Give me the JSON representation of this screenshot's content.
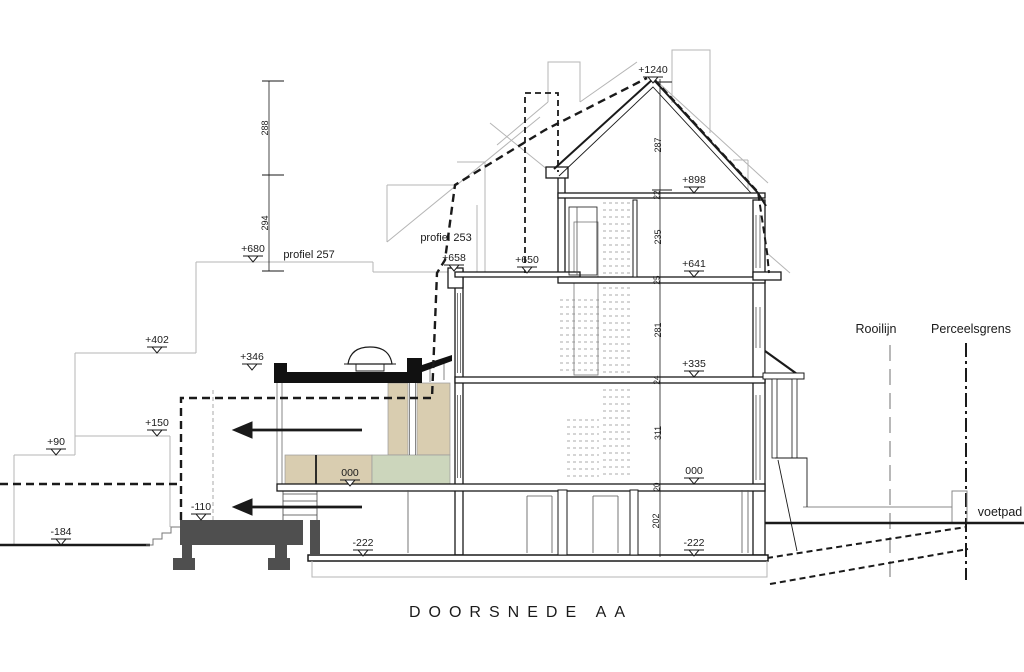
{
  "drawing": {
    "title": "DOORSNEDE AA",
    "annotations": {
      "profiel_257": "profiel 257",
      "profiel_253": "profiel 253",
      "rooilijn": "Rooilijn",
      "perceelsgrens": "Perceelsgrens",
      "voetpad": "voetpad"
    },
    "levels": {
      "ridge": "+1240",
      "attic_floor": "+898",
      "profile_680": "+680",
      "rear_roof_outer": "+658",
      "rear_roof_inner": "+650",
      "second_floor": "+641",
      "profile_402": "+402",
      "extension_roof": "+346",
      "first_floor": "+335",
      "profile_150": "+150",
      "profile_90": "+90",
      "ground_floor_rear": "000",
      "ground_floor_front": "000",
      "garden_terrace": "-110",
      "garden_ground": "-184",
      "basement_rear": "-222",
      "basement_front": "-222"
    },
    "dimensions": {
      "left_upper": "288",
      "left_lower": "294",
      "roof": "287",
      "attic_slab": "22",
      "second": "235",
      "second_slab": "25",
      "first": "281",
      "first_slab": "24",
      "ground": "311",
      "ground_slab": "20",
      "basement": "202"
    },
    "colors": {
      "wall_fill_beige": "#d9cdb0",
      "floor_fill_green": "#ccd6bc",
      "concrete_dark": "#4f4f4f",
      "ink": "#1a1a1a",
      "background_gray": "#b5b5b5"
    }
  }
}
